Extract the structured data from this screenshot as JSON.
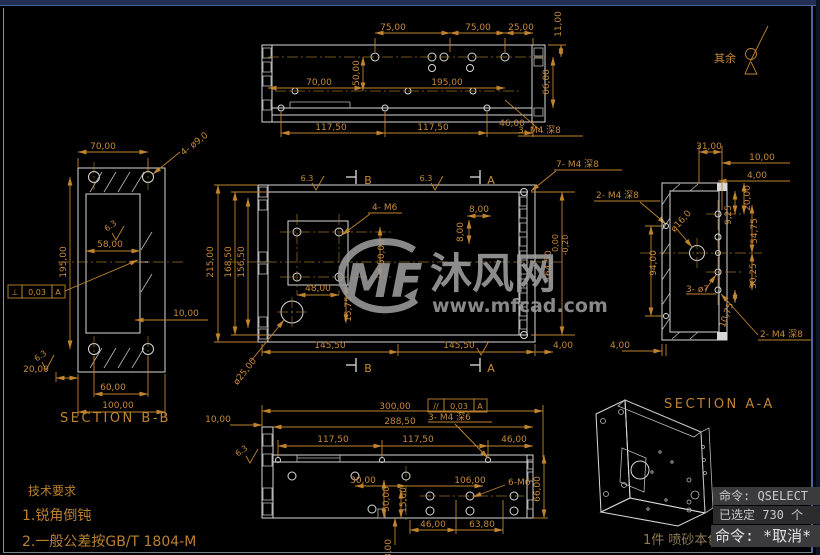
{
  "colors": {
    "background": "#000000",
    "dimension": "#c0842f",
    "geometry": "#d9d9d9",
    "watermark": "#9b9b9b",
    "command_bg": "#3b3b3d",
    "chrome_blue": "#4a67a5"
  },
  "views": {
    "top": {
      "d75a": "75,00",
      "d75b": "75,00",
      "d25": "25,00",
      "d11": "11,00",
      "d66": "66,00",
      "d50": "50,00",
      "d70": "70,00",
      "d195": "195,00",
      "d117a": "117,50",
      "d117b": "117,50",
      "d46": "46,00",
      "note": "3- M4 深8"
    },
    "bb": {
      "label": "SECTION B-B",
      "d70": "70,00",
      "note_holes": "4- ø9,0",
      "d58": "58,00",
      "d195": "195,00",
      "d10": "10,00",
      "d20": "20,00",
      "d60": "60,00",
      "d100": "100,00",
      "gdt_sym": "⊥",
      "gdt_val": "0,03",
      "gdt_datum": "A",
      "rough": "6.3"
    },
    "front": {
      "d215": "215,00",
      "d168": "168,50",
      "d156": "156,50",
      "note_m6": "4- M6",
      "d48": "48,00",
      "d50": "50,00",
      "d1575": "15,75",
      "d145a": "145,50",
      "d145b": "145,50",
      "d4a": "4,00",
      "d4b": "4,00",
      "d8a": "8,00",
      "d8b": "8,00",
      "d164": "164,50",
      "tol_hi": "0,00",
      "tol_lo": "-0,20",
      "note_c25": "ø25,00",
      "note_m4_7": "7- M4 深8",
      "note_m4_2": "2- M4 深8",
      "mark_a": "A",
      "mark_b": "B",
      "rough": "6.3"
    },
    "aa": {
      "label": "SECTION A-A",
      "d31": "31,00",
      "d10": "10,00",
      "d4": "4,00",
      "d20": "20,00",
      "d925": "9,25",
      "d5475": "54,75",
      "d94": "94,00",
      "d3025": "30,25",
      "d1075": "10,75",
      "note_c16": "ø16,0",
      "note_7": "3- ø7",
      "note_m4": "2- M4 深8"
    },
    "bottom": {
      "d300": "300,00",
      "gdt_sym": "//",
      "gdt_val": "0,03",
      "gdt_datum": "A",
      "d288": "288,50",
      "note_m4": "3- M4 深6",
      "d117a": "117,50",
      "d117b": "117,50",
      "d46a": "46,00",
      "d30": "30,00",
      "d106": "106,00",
      "d50": "50,00",
      "d15": "15,00",
      "d46b": "46,00",
      "d638": "63,80",
      "d66": "66,00",
      "note_m6": "6-M6",
      "d10": "10,00",
      "d8": "8,00",
      "rough": "6.3"
    }
  },
  "annotations": {
    "surface_rest": "其余",
    "tech_title": "技术要求",
    "tech_1": "1.锐角倒钝",
    "tech_2": "2.一般公差按GB/T 1804-M",
    "part_note": "1件 喷砂本色"
  },
  "watermark": {
    "logo": "MF",
    "name": "沐风网",
    "url": "www.mfcad.com"
  },
  "command": {
    "lines": {
      "history1": "命令: QSELECT",
      "history2": "已选定 730 个",
      "prompt": "命令: *取消*"
    }
  }
}
